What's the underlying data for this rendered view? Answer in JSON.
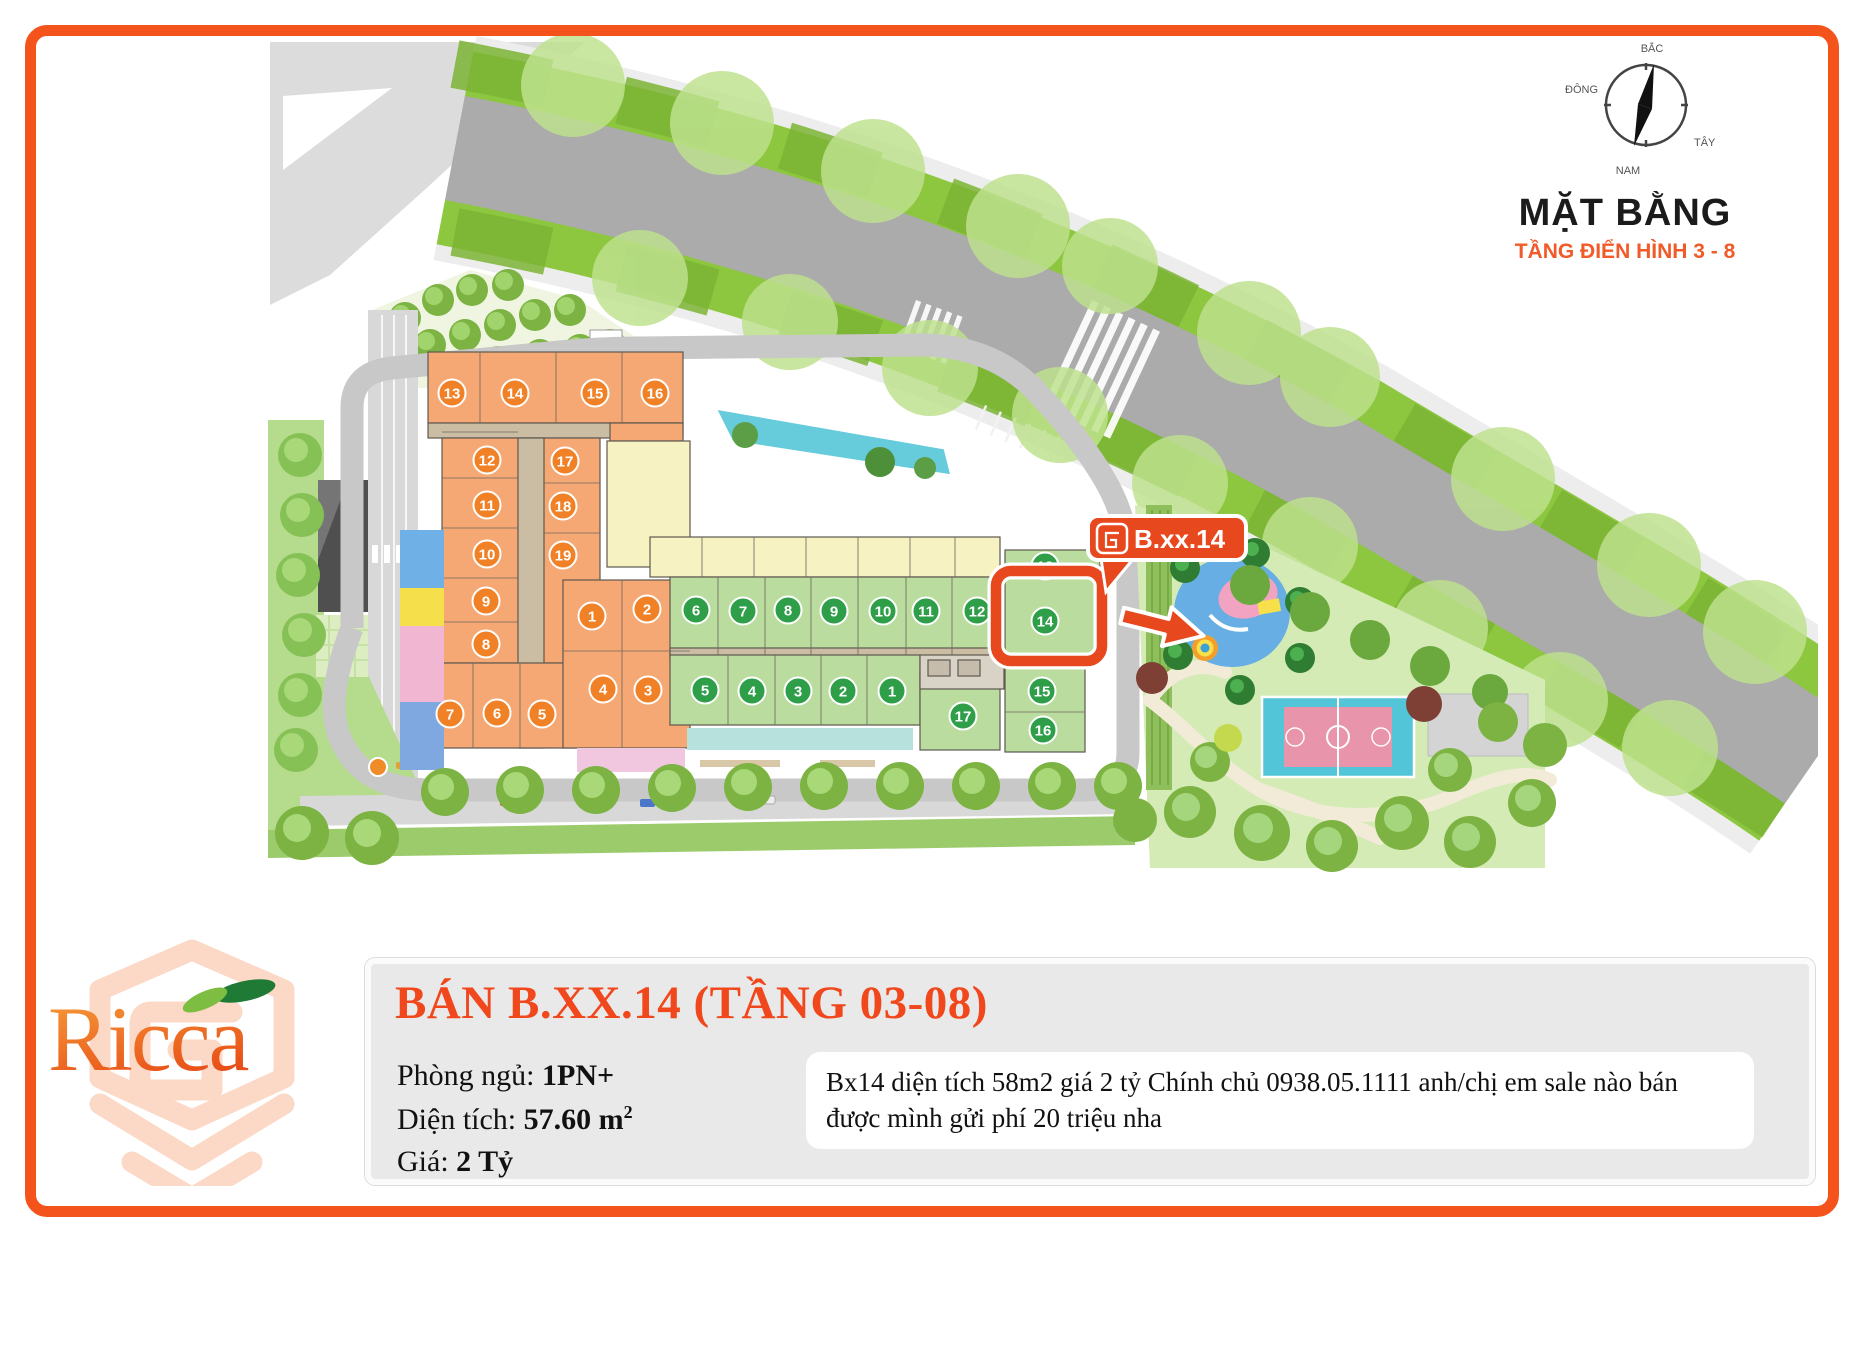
{
  "colors": {
    "frame": "#F4541C",
    "accent": "#E8481E",
    "title_text": "#F0481C",
    "subtitle_text": "#F15A29",
    "orange_badge": "#F08126",
    "green_badge": "#2F9E49"
  },
  "compass": {
    "north": "BẮC",
    "south": "NAM",
    "east": "ĐÔNG",
    "west": "TÂY"
  },
  "header": {
    "title": "MẶT BẰNG",
    "subtitle": "TẦNG ĐIỂN HÌNH 3 - 8"
  },
  "plan": {
    "callout_label": "B.xx.14",
    "orange_units": [
      {
        "n": "13",
        "x": 452,
        "y": 393
      },
      {
        "n": "14",
        "x": 515,
        "y": 393
      },
      {
        "n": "15",
        "x": 595,
        "y": 393
      },
      {
        "n": "16",
        "x": 655,
        "y": 393
      },
      {
        "n": "12",
        "x": 487,
        "y": 460
      },
      {
        "n": "17",
        "x": 565,
        "y": 461
      },
      {
        "n": "11",
        "x": 487,
        "y": 505
      },
      {
        "n": "18",
        "x": 563,
        "y": 506
      },
      {
        "n": "10",
        "x": 487,
        "y": 554
      },
      {
        "n": "19",
        "x": 563,
        "y": 555
      },
      {
        "n": "9",
        "x": 486,
        "y": 601
      },
      {
        "n": "8",
        "x": 486,
        "y": 644
      },
      {
        "n": "1",
        "x": 592,
        "y": 616
      },
      {
        "n": "2",
        "x": 647,
        "y": 609
      },
      {
        "n": "4",
        "x": 603,
        "y": 689
      },
      {
        "n": "3",
        "x": 648,
        "y": 690
      },
      {
        "n": "7",
        "x": 450,
        "y": 714
      },
      {
        "n": "6",
        "x": 497,
        "y": 713
      },
      {
        "n": "5",
        "x": 542,
        "y": 714
      }
    ],
    "green_units": [
      {
        "n": "6",
        "x": 696,
        "y": 610
      },
      {
        "n": "7",
        "x": 743,
        "y": 611
      },
      {
        "n": "8",
        "x": 788,
        "y": 610
      },
      {
        "n": "9",
        "x": 834,
        "y": 611
      },
      {
        "n": "10",
        "x": 883,
        "y": 611
      },
      {
        "n": "11",
        "x": 926,
        "y": 611
      },
      {
        "n": "12",
        "x": 977,
        "y": 611
      },
      {
        "n": "13",
        "x": 1045,
        "y": 566
      },
      {
        "n": "14",
        "x": 1045,
        "y": 621
      },
      {
        "n": "5",
        "x": 705,
        "y": 690
      },
      {
        "n": "4",
        "x": 752,
        "y": 691
      },
      {
        "n": "3",
        "x": 798,
        "y": 691
      },
      {
        "n": "2",
        "x": 843,
        "y": 691
      },
      {
        "n": "1",
        "x": 892,
        "y": 691
      },
      {
        "n": "17",
        "x": 963,
        "y": 716
      },
      {
        "n": "15",
        "x": 1042,
        "y": 691
      },
      {
        "n": "16",
        "x": 1043,
        "y": 730
      }
    ]
  },
  "logo": {
    "brand": "Ricca"
  },
  "panel": {
    "title": "BÁN B.XX.14 (TẦNG 03-08)",
    "bedroom_label": "Phòng ngủ:",
    "bedroom_value": "1PN+",
    "area_label": "Diện tích:",
    "area_value": "57.60",
    "area_unit": "m",
    "area_sup": "2",
    "price_label": "Giá:",
    "price_value": "2 Tỷ",
    "note": "Bx14 diện tích 58m2 giá 2 tỷ Chính chủ 0938.05.1111 anh/chị em sale nào bán được mình gửi phí 20 triệu nha"
  }
}
